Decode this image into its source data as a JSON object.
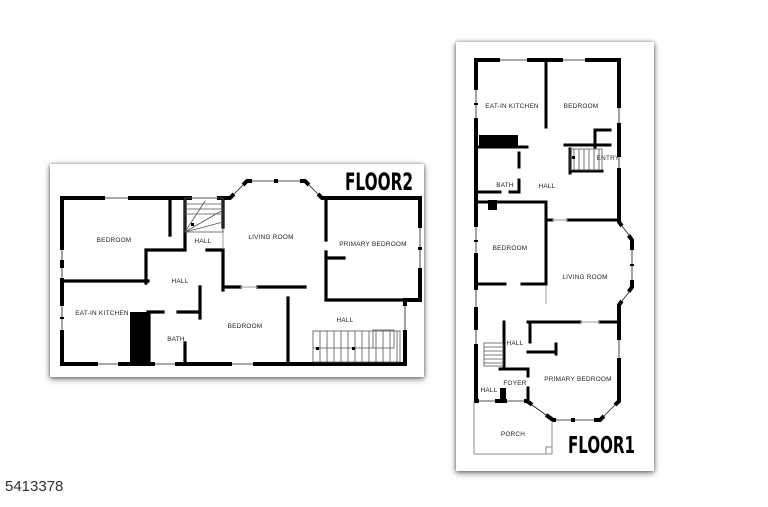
{
  "page": {
    "background": "#ffffff",
    "mls_number": "5413378",
    "wall_color": "#000000",
    "label_color": "#222222",
    "title_color": "#000000"
  },
  "floor2": {
    "title": "FLOOR2",
    "rooms": {
      "bedroom_upper": "BEDROOM",
      "hall_upper": "HALL",
      "living_room": "LIVING ROOM",
      "primary_bedroom": "PRIMARY BEDROOM",
      "hall_center": "HALL",
      "eat_in_kitchen": "EAT-IN KITCHEN",
      "bath": "BATH",
      "bedroom_lower": "BEDROOM",
      "hall_stairs": "HALL"
    }
  },
  "floor1": {
    "title": "FLOOR1",
    "rooms": {
      "eat_in_kitchen": "EAT-IN KITCHEN",
      "bedroom_upper": "BEDROOM",
      "entry": "ENTRY",
      "bath": "BATH",
      "hall_upper": "HALL",
      "bedroom_mid": "BEDROOM",
      "living_room": "LIVING ROOM",
      "hall_center": "HALL",
      "foyer": "FOYER",
      "hall_lower": "HALL",
      "primary_bedroom": "PRIMARY BEDROOM",
      "porch": "PORCH"
    }
  }
}
